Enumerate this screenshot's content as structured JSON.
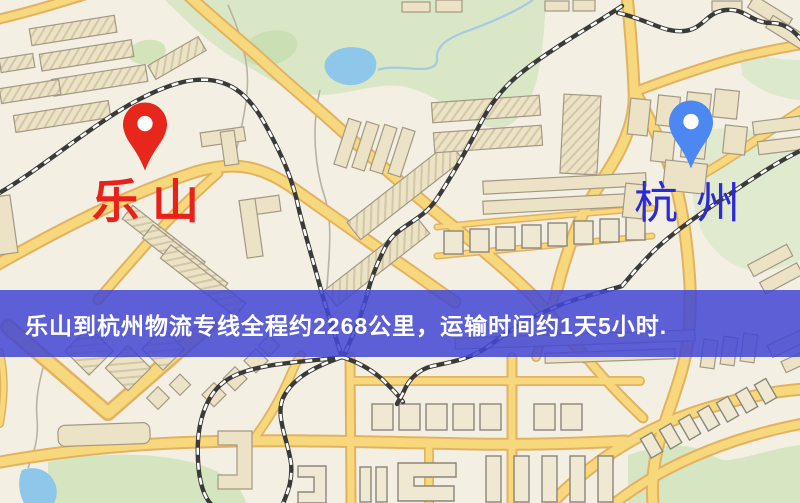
{
  "map": {
    "origin": {
      "name": "乐山",
      "label_color": "#e8221a",
      "pin_color": "#e7261c"
    },
    "destination": {
      "name": "杭州",
      "label_color": "#2a2ad8",
      "pin_color": "#4d87f2"
    },
    "banner": {
      "text": "乐山到杭州物流专线全程约2268公里，运输时间约1天5小时.",
      "background": "#4247d4",
      "text_color": "#ffffff"
    },
    "route": {
      "distance_km": "2268",
      "duration": "1天5小时"
    },
    "palette": {
      "background": "#f3efe3",
      "road_fill": "#f8d87d",
      "road_casing": "#e2b261",
      "park": "#d9e7c6",
      "water": "#8fc7ea",
      "railway": "#3a3a38"
    }
  }
}
